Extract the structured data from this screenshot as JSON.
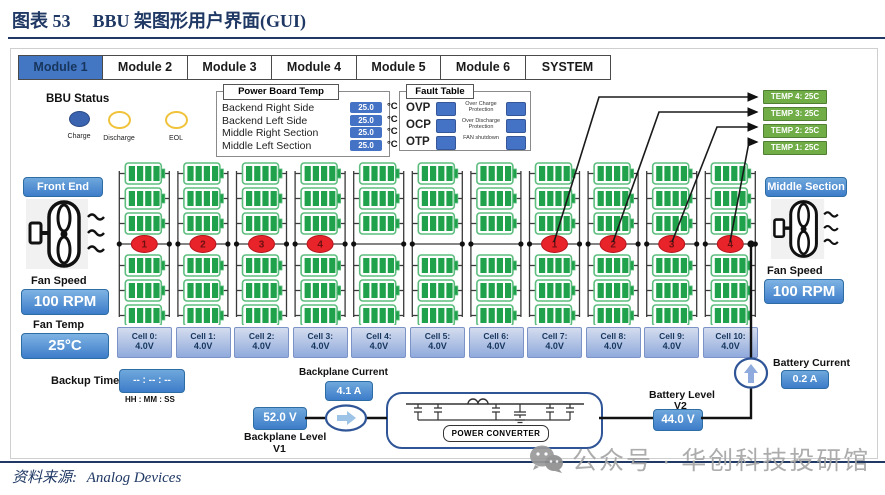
{
  "figure": {
    "label": "图表 53",
    "title": "BBU 架图形用户界面(GUI)",
    "source_label": "资料来源:",
    "source_text": "Analog Devices",
    "watermark": "公众号 · 华创科技投研馆"
  },
  "tabs": [
    {
      "label": "Module 1",
      "selected": true
    },
    {
      "label": "Module 2",
      "selected": false
    },
    {
      "label": "Module 3",
      "selected": false
    },
    {
      "label": "Module 4",
      "selected": false
    },
    {
      "label": "Module 5",
      "selected": false
    },
    {
      "label": "Module 6",
      "selected": false
    },
    {
      "label": "SYSTEM",
      "selected": false
    }
  ],
  "bbu_status": {
    "title": "BBU Status",
    "indicators": [
      {
        "label": "Charge",
        "color": "#3A63B0",
        "filled": true
      },
      {
        "label": "Discharge",
        "color": "#F0C33C",
        "filled": false
      },
      {
        "label": "EOL",
        "color": "#F0C33C",
        "filled": false
      },
      {
        "label": "FAULT",
        "color": "#D93030",
        "filled": false
      }
    ]
  },
  "power_board_temp": {
    "title": "Power Board Temp",
    "unit": "°C",
    "rows": [
      {
        "label": "Backend Right Side",
        "value": "25.0"
      },
      {
        "label": "Backend Left Side",
        "value": "25.0"
      },
      {
        "label": "Middle Right Section",
        "value": "25.0"
      },
      {
        "label": "Middle Left Section",
        "value": "25.0"
      }
    ]
  },
  "fault_table": {
    "title": "Fault Table",
    "rows": [
      {
        "code": "OVP",
        "desc": "Over Charge Protection"
      },
      {
        "code": "OCP",
        "desc": "Over Discharge Protection"
      },
      {
        "code": "OTP",
        "desc": "FAN shutdown"
      }
    ]
  },
  "temp_boxes": [
    "TEMP 4: 25C",
    "TEMP 3: 25C",
    "TEMP 2: 25C",
    "TEMP 1: 25C"
  ],
  "front_end": {
    "title": "Front End",
    "fan_speed_label": "Fan Speed",
    "fan_speed": "100 RPM",
    "fan_temp_label": "Fan Temp",
    "fan_temp": "25°C"
  },
  "middle_section": {
    "title": "Middle Section",
    "fan_speed_label": "Fan Speed",
    "fan_speed": "100 RPM"
  },
  "battery_grid": {
    "columns": 11,
    "battery_rows": 6,
    "battery_color": "#1FA24B",
    "marker_color": "#E8232A",
    "marker_groups": [
      {
        "columns": [
          0,
          1,
          2,
          3
        ],
        "labels": [
          "1",
          "2",
          "3",
          "4"
        ]
      },
      {
        "columns": [
          7,
          8,
          9,
          10
        ],
        "labels": [
          "1",
          "2",
          "3",
          "4"
        ]
      }
    ],
    "cells": [
      {
        "label": "Cell 0:",
        "voltage": "4.0V"
      },
      {
        "label": "Cell 1:",
        "voltage": "4.0V"
      },
      {
        "label": "Cell 2:",
        "voltage": "4.0V"
      },
      {
        "label": "Cell 3:",
        "voltage": "4.0V"
      },
      {
        "label": "Cell 4:",
        "voltage": "4.0V"
      },
      {
        "label": "Cell 5:",
        "voltage": "4.0V"
      },
      {
        "label": "Cell 6:",
        "voltage": "4.0V"
      },
      {
        "label": "Cell 7:",
        "voltage": "4.0V"
      },
      {
        "label": "Cell 8:",
        "voltage": "4.0V"
      },
      {
        "label": "Cell 9:",
        "voltage": "4.0V"
      },
      {
        "label": "Cell 10:",
        "voltage": "4.0V"
      }
    ]
  },
  "bottom": {
    "backup_timer_label": "Backup Timer",
    "backup_timer_value": "-- : -- : --",
    "backup_timer_format": "HH : MM : SS",
    "backplane_current_label": "Backplane Current",
    "backplane_current": "4.1 A",
    "backplane_level": "52.0 V",
    "backplane_level_label": "Backplane Level",
    "backplane_level_sub": "V1",
    "power_converter_label": "POWER CONVERTER",
    "battery_level_label": "Battery Level",
    "battery_level_sub": "V2",
    "battery_level": "44.0 V",
    "battery_current_label": "Battery Current",
    "battery_current": "0.2 A"
  }
}
